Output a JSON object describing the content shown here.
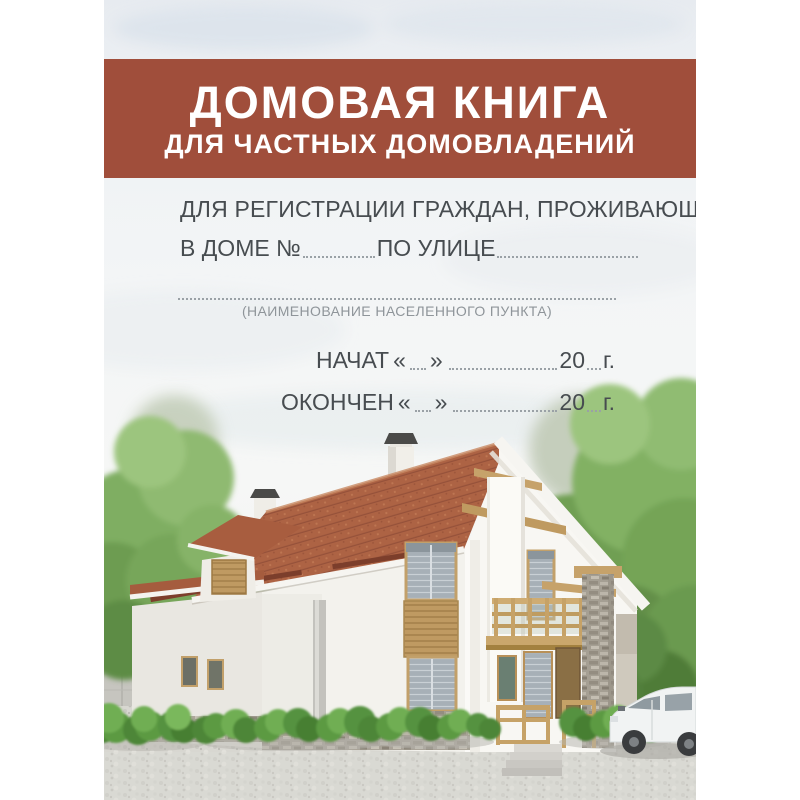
{
  "cover": {
    "band": {
      "title": "ДОМОВАЯ КНИГА",
      "subtitle": "ДЛЯ ЧАСТНЫХ ДОМОВЛАДЕНИЙ"
    },
    "registration": {
      "line1": "ДЛЯ РЕГИСТРАЦИИ ГРАЖДАН, ПРОЖИВАЮЩИХ",
      "house_label": "В ДОМЕ №",
      "street_label": "ПО УЛИЦЕ"
    },
    "settlement_caption": "(НАИМЕНОВАНИЕ НАСЕЛЕННОГО ПУНКТА)",
    "dates": {
      "started_label": "НАЧАТ",
      "finished_label": "ОКОНЧЕН",
      "quote_open": "«",
      "quote_close": "»",
      "year_prefix": "20",
      "year_suffix": "г."
    },
    "colors": {
      "band": "#a04e3b",
      "band_text": "#ffffff",
      "text": "#474c50",
      "muted": "#8f959a",
      "dots": "#9aa1a6",
      "roof": "#ab6243",
      "wall": "#f4f3ef",
      "wood": "#c2a06a",
      "foliage": "#7dab60",
      "sky": "#eef1f3",
      "ground": "#d8d7d2"
    }
  },
  "illustration": {
    "name": "house-render",
    "elements": [
      "sky",
      "clouds",
      "trees",
      "stone-fence",
      "house",
      "roof",
      "chimneys",
      "dormer",
      "balcony",
      "stone-pillar",
      "porch-steps",
      "bushes",
      "gravel-driveway",
      "white-car"
    ]
  }
}
